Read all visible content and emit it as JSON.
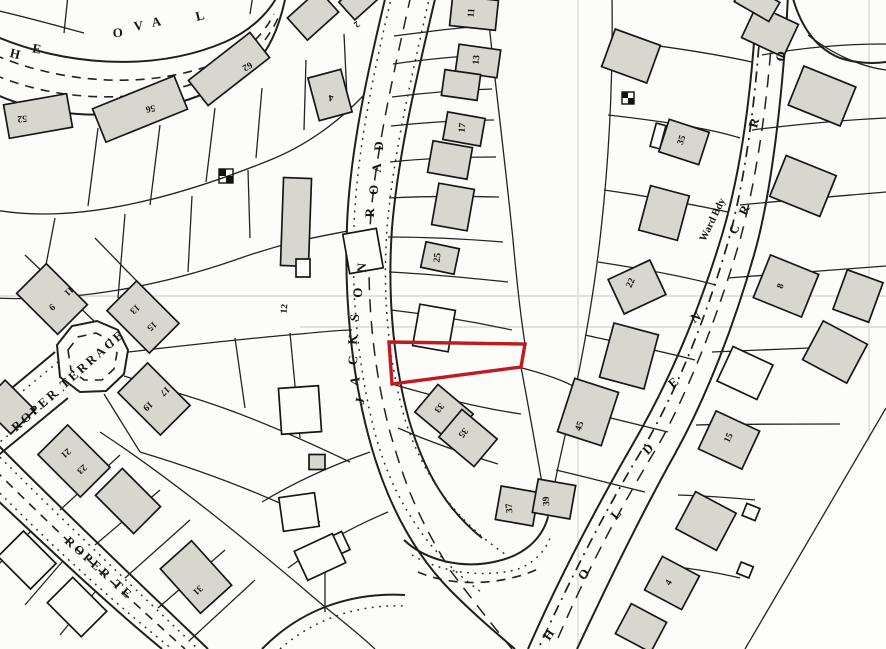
{
  "map": {
    "type": "scanned cadastral site plan",
    "background_color": "#fcfcf9",
    "line_color": "#1f1f1f",
    "building_fill": "#d7d7d0",
    "highlight_color": "#c01a20",
    "highlighted_plot": {
      "description": "subject site outlined in red on east side of Jackson Road",
      "points": "389,342 525,344 521,367 392,384",
      "stroke": "#c01a20",
      "stroke_width": 3.4
    },
    "streets": [
      {
        "name": "THE OVAL",
        "letters": [
          {
            "t": "H",
            "x": 14,
            "y": 58,
            "r": 14
          },
          {
            "t": "E",
            "x": 36,
            "y": 53,
            "r": 10
          },
          {
            "t": "O",
            "x": 118,
            "y": 37,
            "r": -4
          },
          {
            "t": "V",
            "x": 139,
            "y": 30,
            "r": -8
          },
          {
            "t": "A",
            "x": 157,
            "y": 26,
            "r": -10
          },
          {
            "t": "L",
            "x": 201,
            "y": 20,
            "r": -14
          }
        ]
      },
      {
        "name": "JACKSON ROAD",
        "letters": [
          {
            "t": "J",
            "x": 364,
            "y": 402,
            "r": -78
          },
          {
            "t": "A",
            "x": 359,
            "y": 382,
            "r": -80
          },
          {
            "t": "C",
            "x": 357,
            "y": 361,
            "r": -82
          },
          {
            "t": "K",
            "x": 357,
            "y": 340,
            "r": -84
          },
          {
            "t": "S",
            "x": 359,
            "y": 318,
            "r": -85
          },
          {
            "t": "O",
            "x": 362,
            "y": 293,
            "r": -86
          },
          {
            "t": "N",
            "x": 366,
            "y": 268,
            "r": -87
          },
          {
            "t": "R",
            "x": 374,
            "y": 213,
            "r": -88
          },
          {
            "t": "O",
            "x": 378,
            "y": 190,
            "r": -89
          },
          {
            "t": "A",
            "x": 381,
            "y": 168,
            "r": -89
          },
          {
            "t": "D",
            "x": 383,
            "y": 146,
            "r": -90
          }
        ]
      },
      {
        "name": "HOLDEN",
        "letters": [
          {
            "t": "H",
            "x": 552,
            "y": 637,
            "r": -56
          },
          {
            "t": "O",
            "x": 587,
            "y": 577,
            "r": -53
          },
          {
            "t": "L",
            "x": 619,
            "y": 517,
            "r": -50
          },
          {
            "t": "D",
            "x": 651,
            "y": 452,
            "r": -45
          },
          {
            "t": "E",
            "x": 676,
            "y": 386,
            "r": -40
          },
          {
            "t": "N",
            "x": 698,
            "y": 321,
            "r": -33
          }
        ]
      },
      {
        "name": "C R ... R O (partial street name along ward boundary road)",
        "letters": [
          {
            "t": "C",
            "x": 738,
            "y": 231,
            "r": -64
          },
          {
            "t": "R",
            "x": 748,
            "y": 212,
            "r": -64
          },
          {
            "t": "R",
            "x": 758,
            "y": 124,
            "r": -74
          },
          {
            "t": "O",
            "x": 785,
            "y": 57,
            "r": -80
          }
        ]
      },
      {
        "name": "ROPER TERRACE",
        "text": {
          "value": "ROPER TERRACE",
          "x": 16,
          "y": 432,
          "r": -41.5
        }
      },
      {
        "name": "ROPER TE (continuation)",
        "text": {
          "value": "ROPER  TE",
          "x": 64,
          "y": 542,
          "r": 42
        }
      }
    ],
    "annotations": [
      {
        "text": "Ward Bdy",
        "x": 705,
        "y": 242,
        "r": -64
      }
    ],
    "plot_numbers": [
      {
        "t": "52",
        "x": 22,
        "y": 116,
        "r": 176
      },
      {
        "t": "56",
        "x": 150,
        "y": 106,
        "r": 170
      },
      {
        "t": "62",
        "x": 246,
        "y": 64,
        "r": 150
      },
      {
        "t": "4",
        "x": 331,
        "y": 95,
        "r": 178
      },
      {
        "t": "2",
        "x": 355,
        "y": 22,
        "r": 140
      },
      {
        "t": "12",
        "x": 287,
        "y": 309,
        "r": -85
      },
      {
        "t": "9",
        "x": 50,
        "y": 305,
        "r": 138
      },
      {
        "t": "11",
        "x": 67,
        "y": 289,
        "r": 138
      },
      {
        "t": "13",
        "x": 133,
        "y": 307,
        "r": 138
      },
      {
        "t": "15",
        "x": 150,
        "y": 324,
        "r": 138
      },
      {
        "t": "17",
        "x": 163,
        "y": 389,
        "r": 138
      },
      {
        "t": "19",
        "x": 146,
        "y": 404,
        "r": 138
      },
      {
        "t": "21",
        "x": 64,
        "y": 451,
        "r": 138
      },
      {
        "t": "23",
        "x": 80,
        "y": 467,
        "r": 138
      },
      {
        "t": "31",
        "x": 196,
        "y": 588,
        "r": 138
      },
      {
        "t": "11",
        "x": 474,
        "y": 13,
        "r": -86
      },
      {
        "t": "13",
        "x": 479,
        "y": 60,
        "r": -86
      },
      {
        "t": "17",
        "x": 465,
        "y": 128,
        "r": -84
      },
      {
        "t": "25",
        "x": 440,
        "y": 258,
        "r": -84
      },
      {
        "t": "33",
        "x": 437,
        "y": 406,
        "r": 130
      },
      {
        "t": "35",
        "x": 461,
        "y": 431,
        "r": 130
      },
      {
        "t": "37",
        "x": 512,
        "y": 508,
        "r": -95
      },
      {
        "t": "39",
        "x": 549,
        "y": 501,
        "r": -95
      },
      {
        "t": "45",
        "x": 582,
        "y": 427,
        "r": -70
      },
      {
        "t": "22",
        "x": 633,
        "y": 284,
        "r": -65
      },
      {
        "t": "35",
        "x": 684,
        "y": 141,
        "r": -70
      },
      {
        "t": "8",
        "x": 783,
        "y": 287,
        "r": -70
      },
      {
        "t": "15",
        "x": 731,
        "y": 439,
        "r": -65
      },
      {
        "t": "4",
        "x": 671,
        "y": 584,
        "r": -60
      }
    ],
    "buildings": [
      {
        "cx": 38,
        "cy": 116,
        "w": 64,
        "h": 34,
        "r": -10,
        "f": "g"
      },
      {
        "cx": 140,
        "cy": 109,
        "w": 88,
        "h": 36,
        "r": -22,
        "f": "g"
      },
      {
        "cx": 229,
        "cy": 69,
        "w": 78,
        "h": 32,
        "r": -38,
        "f": "g"
      },
      {
        "cx": 330,
        "cy": 95,
        "w": 34,
        "h": 44,
        "r": -15,
        "f": "g"
      },
      {
        "cx": 313,
        "cy": 15,
        "w": 42,
        "h": 30,
        "r": -42,
        "f": "g"
      },
      {
        "cx": 358,
        "cy": 1,
        "w": 30,
        "h": 24,
        "r": -42,
        "f": "g"
      },
      {
        "cx": 296,
        "cy": 222,
        "w": 28,
        "h": 88,
        "r": 2,
        "f": "g"
      },
      {
        "cx": 303,
        "cy": 268,
        "w": 14,
        "h": 18,
        "r": 0,
        "f": "w"
      },
      {
        "cx": 300,
        "cy": 410,
        "w": 40,
        "h": 46,
        "r": -4,
        "f": "w"
      },
      {
        "cx": 317,
        "cy": 462,
        "w": 16,
        "h": 15,
        "r": 0,
        "f": "g"
      },
      {
        "cx": 299,
        "cy": 512,
        "w": 36,
        "h": 34,
        "r": -8,
        "f": "w"
      },
      {
        "cx": 334,
        "cy": 546,
        "w": 26,
        "h": 20,
        "r": -25,
        "f": "w"
      },
      {
        "cx": 52,
        "cy": 299,
        "w": 58,
        "h": 42,
        "r": 45,
        "f": "g"
      },
      {
        "cx": 143,
        "cy": 317,
        "w": 60,
        "h": 42,
        "r": 45,
        "f": "g"
      },
      {
        "cx": 154,
        "cy": 399,
        "w": 60,
        "h": 42,
        "r": 45,
        "f": "g"
      },
      {
        "cx": 74,
        "cy": 461,
        "w": 60,
        "h": 42,
        "r": 45,
        "f": "g"
      },
      {
        "cx": 8,
        "cy": 407,
        "w": 42,
        "h": 34,
        "r": 45,
        "f": "g"
      },
      {
        "cx": 128,
        "cy": 501,
        "w": 54,
        "h": 38,
        "r": 45,
        "f": "g"
      },
      {
        "cx": 27,
        "cy": 560,
        "w": 46,
        "h": 36,
        "r": 45,
        "f": "w"
      },
      {
        "cx": 77,
        "cy": 607,
        "w": 48,
        "h": 36,
        "r": 45,
        "f": "w"
      },
      {
        "cx": 196,
        "cy": 577,
        "w": 60,
        "h": 42,
        "r": 48,
        "f": "g"
      },
      {
        "cx": 363,
        "cy": 251,
        "w": 34,
        "h": 40,
        "r": -10,
        "f": "w"
      },
      {
        "cx": 320,
        "cy": 557,
        "w": 42,
        "h": 32,
        "r": -25,
        "f": "w"
      },
      {
        "cx": 474,
        "cy": 13,
        "w": 46,
        "h": 30,
        "r": 6,
        "f": "g"
      },
      {
        "cx": 478,
        "cy": 61,
        "w": 42,
        "h": 28,
        "r": 8,
        "f": "g"
      },
      {
        "cx": 461,
        "cy": 85,
        "w": 36,
        "h": 26,
        "r": 8,
        "f": "g"
      },
      {
        "cx": 464,
        "cy": 129,
        "w": 38,
        "h": 28,
        "r": 10,
        "f": "g"
      },
      {
        "cx": 450,
        "cy": 160,
        "w": 40,
        "h": 32,
        "r": 10,
        "f": "g"
      },
      {
        "cx": 453,
        "cy": 207,
        "w": 36,
        "h": 42,
        "r": 10,
        "f": "g"
      },
      {
        "cx": 440,
        "cy": 258,
        "w": 34,
        "h": 26,
        "r": 12,
        "f": "g"
      },
      {
        "cx": 434,
        "cy": 328,
        "w": 36,
        "h": 42,
        "r": 10,
        "f": "w"
      },
      {
        "cx": 444,
        "cy": 413,
        "w": 46,
        "h": 36,
        "r": 40,
        "f": "g"
      },
      {
        "cx": 468,
        "cy": 438,
        "w": 46,
        "h": 36,
        "r": 40,
        "f": "g"
      },
      {
        "cx": 517,
        "cy": 506,
        "w": 38,
        "h": 34,
        "r": 10,
        "f": "g"
      },
      {
        "cx": 554,
        "cy": 499,
        "w": 38,
        "h": 34,
        "r": 10,
        "f": "g"
      },
      {
        "cx": 588,
        "cy": 412,
        "w": 46,
        "h": 56,
        "r": 18,
        "f": "g"
      },
      {
        "cx": 631,
        "cy": 56,
        "w": 48,
        "h": 40,
        "r": 20,
        "f": "g"
      },
      {
        "cx": 684,
        "cy": 142,
        "w": 42,
        "h": 34,
        "r": 18,
        "f": "g"
      },
      {
        "cx": 658,
        "cy": 136,
        "w": 10,
        "h": 24,
        "r": 15,
        "f": "w"
      },
      {
        "cx": 664,
        "cy": 213,
        "w": 40,
        "h": 46,
        "r": 15,
        "f": "g"
      },
      {
        "cx": 637,
        "cy": 287,
        "w": 46,
        "h": 38,
        "r": -25,
        "f": "g"
      },
      {
        "cx": 629,
        "cy": 356,
        "w": 46,
        "h": 56,
        "r": 15,
        "f": "g"
      },
      {
        "cx": 770,
        "cy": 31,
        "w": 46,
        "h": 36,
        "r": 25,
        "f": "g"
      },
      {
        "cx": 822,
        "cy": 96,
        "w": 56,
        "h": 42,
        "r": 22,
        "f": "g"
      },
      {
        "cx": 803,
        "cy": 186,
        "w": 54,
        "h": 44,
        "r": 22,
        "f": "g"
      },
      {
        "cx": 786,
        "cy": 286,
        "w": 52,
        "h": 46,
        "r": 22,
        "f": "g"
      },
      {
        "cx": 858,
        "cy": 296,
        "w": 38,
        "h": 42,
        "r": 20,
        "f": "g"
      },
      {
        "cx": 835,
        "cy": 352,
        "w": 50,
        "h": 44,
        "r": 28,
        "f": "g"
      },
      {
        "cx": 745,
        "cy": 373,
        "w": 44,
        "h": 38,
        "r": 25,
        "f": "w"
      },
      {
        "cx": 729,
        "cy": 440,
        "w": 48,
        "h": 42,
        "r": 25,
        "f": "g"
      },
      {
        "cx": 706,
        "cy": 521,
        "w": 46,
        "h": 42,
        "r": 28,
        "f": "g"
      },
      {
        "cx": 672,
        "cy": 583,
        "w": 42,
        "h": 38,
        "r": 28,
        "f": "g"
      },
      {
        "cx": 641,
        "cy": 628,
        "w": 40,
        "h": 34,
        "r": 28,
        "f": "g"
      },
      {
        "cx": 757,
        "cy": 2,
        "w": 40,
        "h": 22,
        "r": 30,
        "f": "g"
      },
      {
        "cx": 751,
        "cy": 512,
        "w": 14,
        "h": 13,
        "r": 22,
        "f": "w"
      },
      {
        "cx": 745,
        "cy": 570,
        "w": 13,
        "h": 12,
        "r": 22,
        "f": "w"
      }
    ],
    "outbuilding_symbols": [
      {
        "x": 219,
        "y": 169,
        "s": 14
      },
      {
        "x": 622,
        "y": 92,
        "s": 12
      }
    ]
  }
}
